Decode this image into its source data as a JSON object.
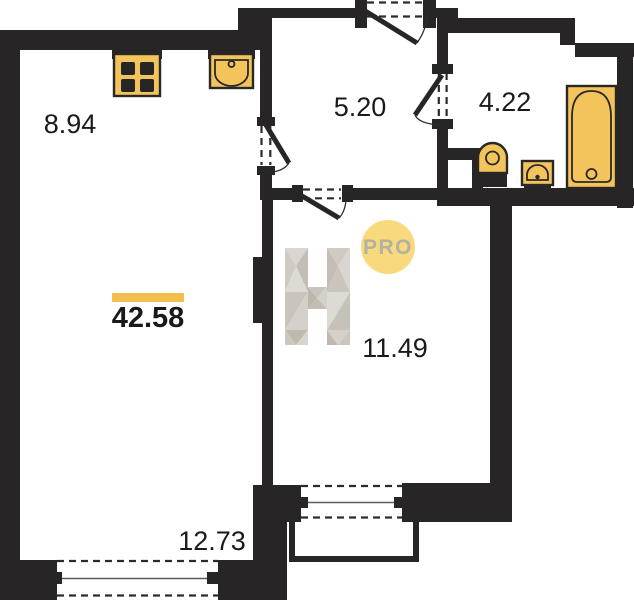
{
  "colors": {
    "wall": "#272525",
    "fixture": "#F3C45C",
    "badge_fill": "#F8D97E",
    "badge_text": "#B5B0A2",
    "accent_bar": "#F2BE4E",
    "text": "#1A1A1A",
    "logo_gray_light": "#DDDAD4",
    "logo_gray_mid": "#CBC7BF",
    "logo_gray_dark": "#BFBAB0"
  },
  "labels": {
    "total_area": "42.58",
    "kitchen_zone": "8.94",
    "hallway": "5.20",
    "bathroom": "4.22",
    "room": "11.49",
    "living_zone": "12.73"
  },
  "logo": {
    "badge": "PRO"
  }
}
